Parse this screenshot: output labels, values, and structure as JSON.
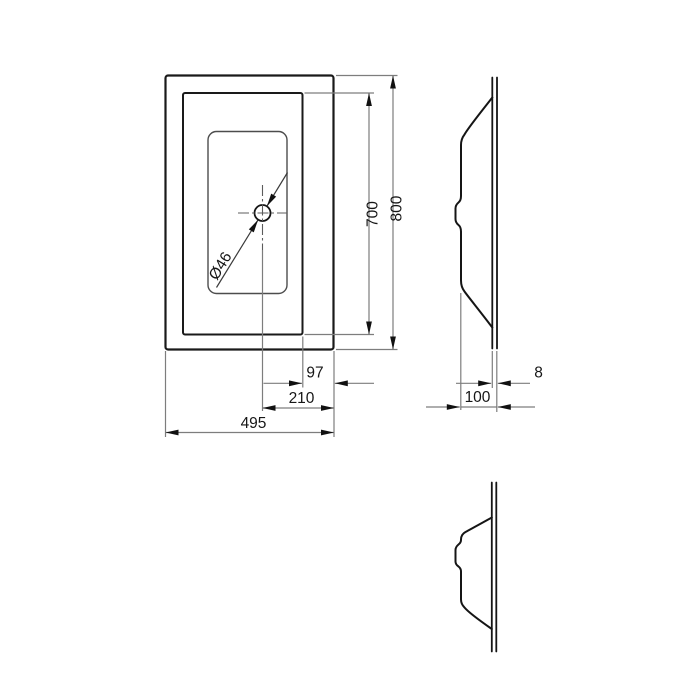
{
  "drawing": {
    "dims": {
      "outer_height": "800",
      "inner_height": "700",
      "right_edge_to_inner": "97",
      "right_edge_to_drain": "210",
      "outer_width": "495",
      "rim_thickness": "8",
      "depth": "100",
      "drain_diameter": "Ø46"
    },
    "colors": {
      "line_strong": "#1a1a1a",
      "line_medium": "#4d4d4d",
      "line_thin": "#7d7d7d",
      "text": "#161616",
      "background": "#ffffff"
    }
  }
}
